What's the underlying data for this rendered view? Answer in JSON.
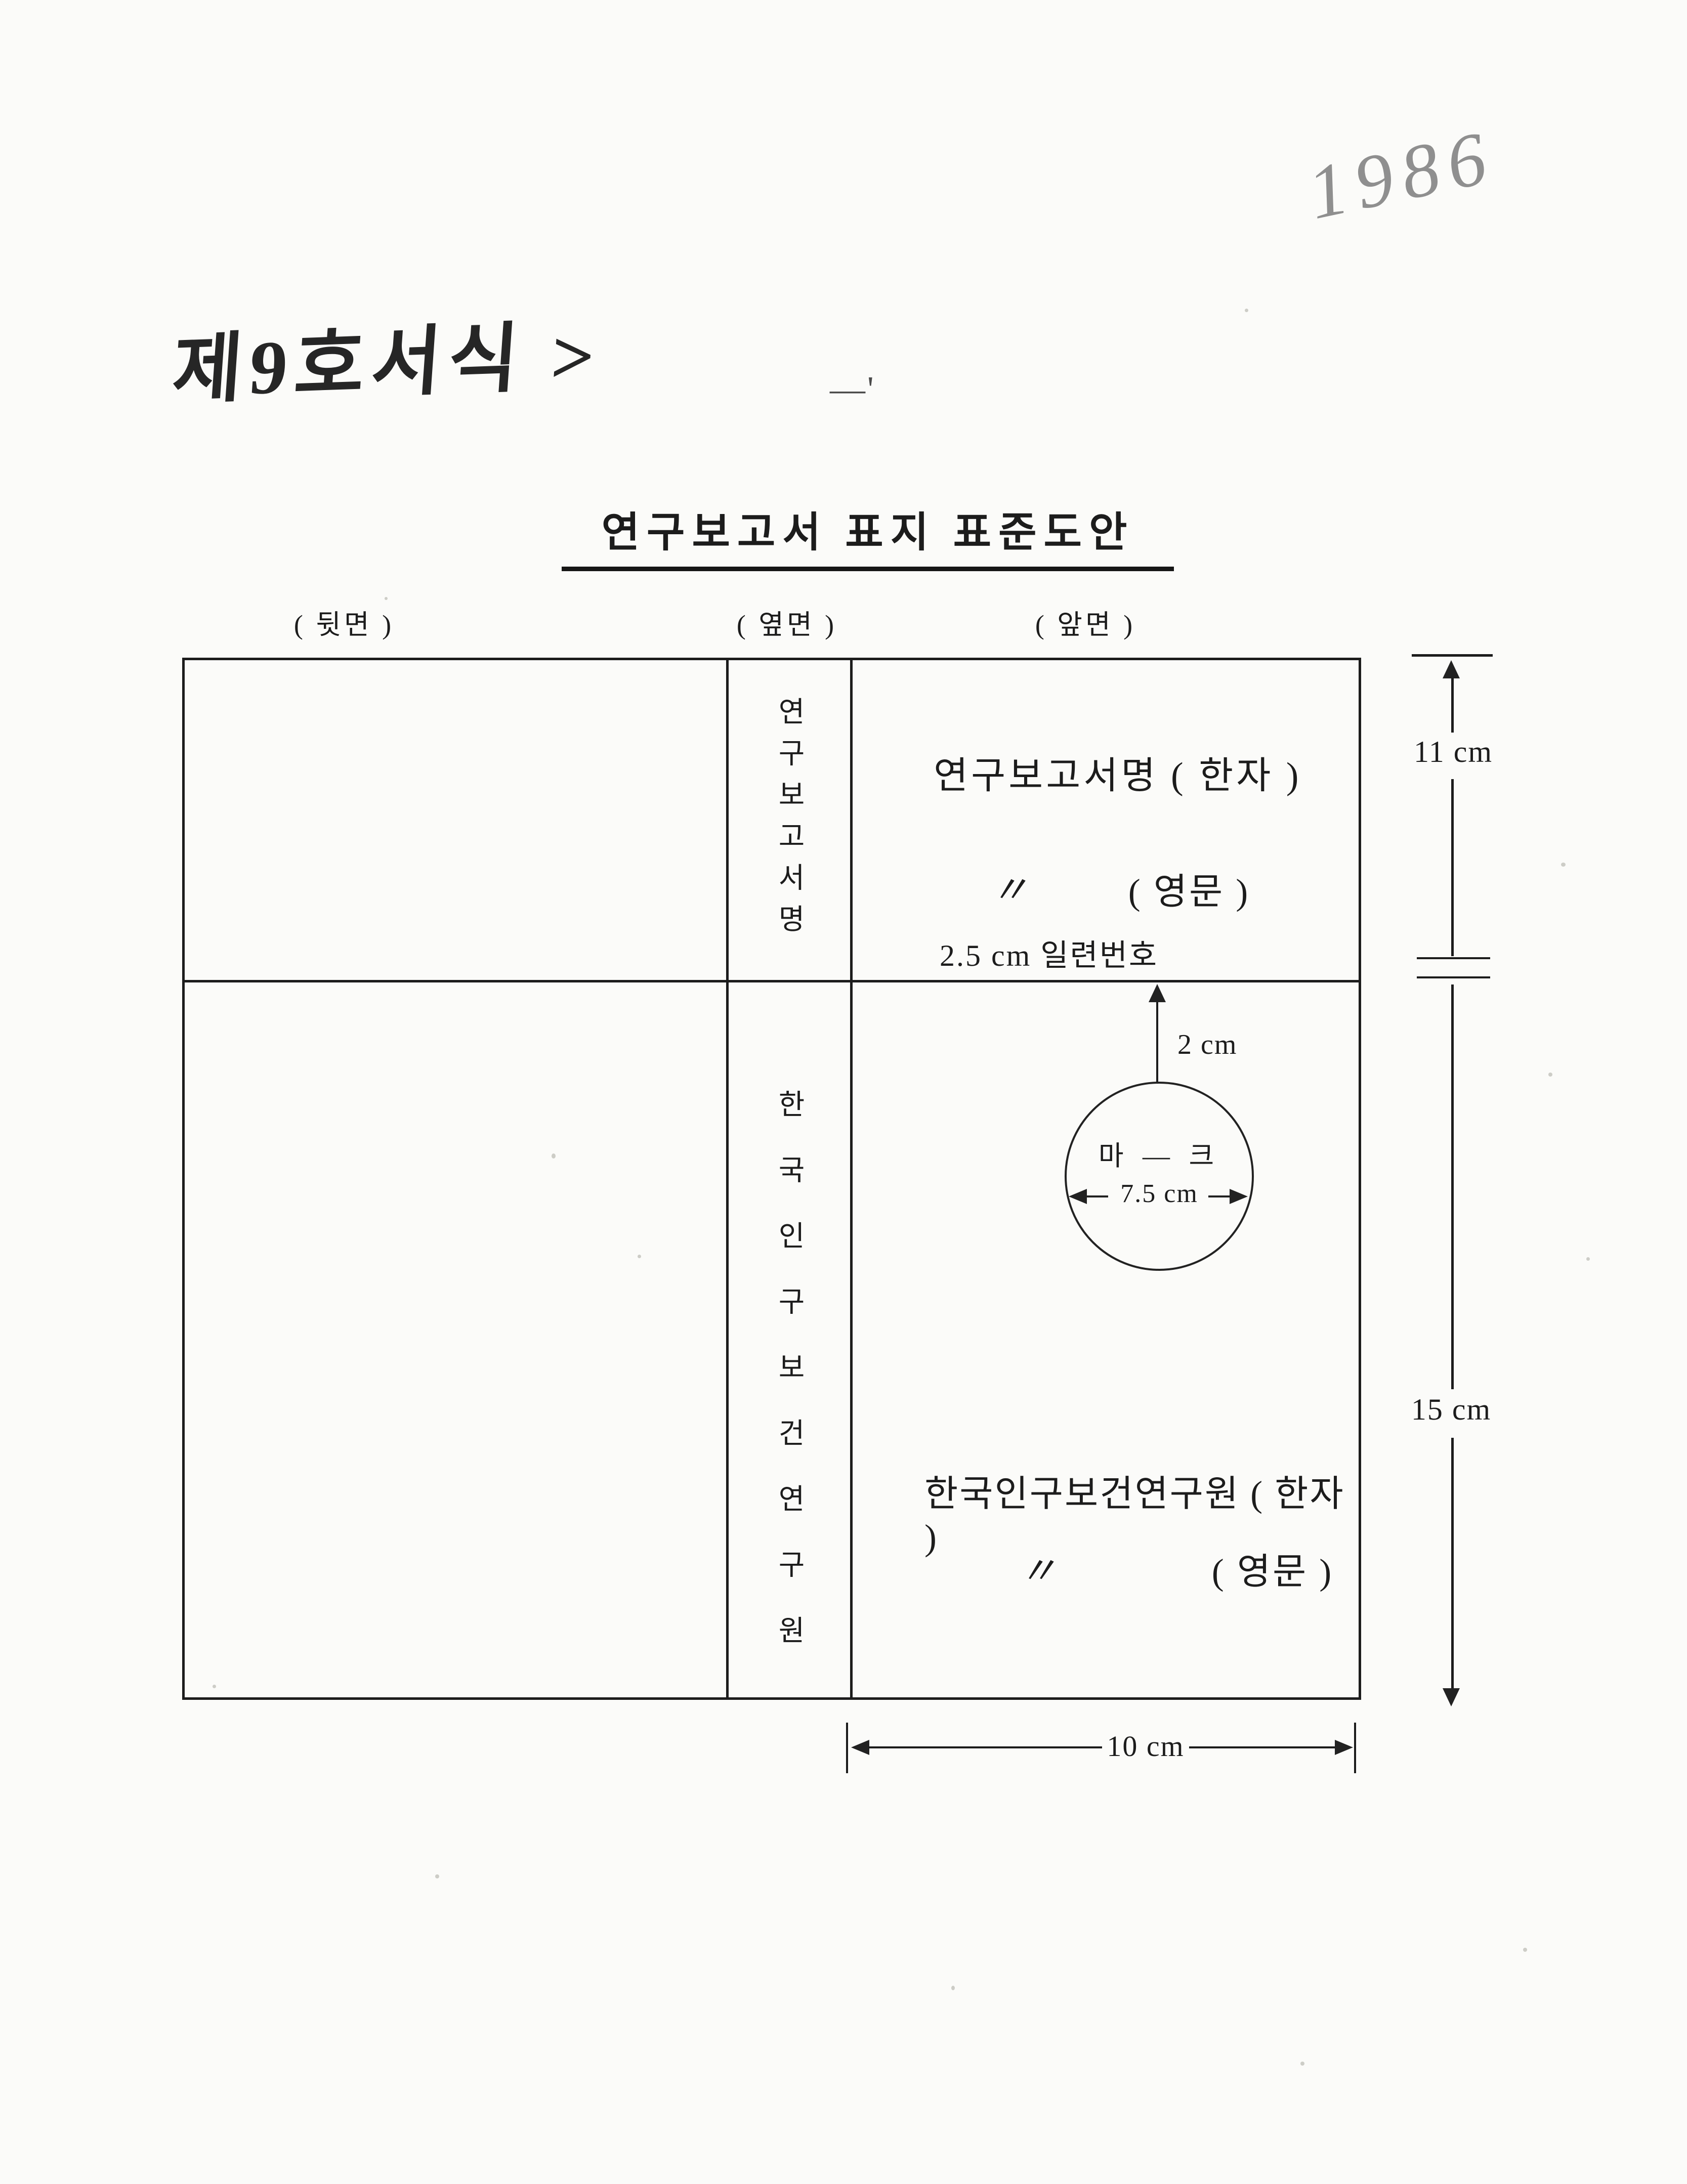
{
  "page": {
    "year_note": "1986",
    "form_note": "제9호서식 >",
    "stray_mark": "―'",
    "title": "연구보고서 표지 표준도안"
  },
  "panel_labels": {
    "back": "( 뒷면 )",
    "side": "( 옆면 )",
    "front": "( 앞면 )"
  },
  "spine": {
    "report_title_vertical": "연구보고서명",
    "org_name_vertical": "한국인구보건연구원"
  },
  "front": {
    "report_title_hanja": "연구보고서명 ( 한자 )",
    "ditto_mark": "〃",
    "report_title_english": "( 영문 )",
    "serial_note": "2.5 cm  일련번호",
    "mark_gap_label": "2 cm",
    "mark_text": "마 ― 크",
    "mark_diameter_label": "7.5 cm",
    "org_name_hanja": "한국인구보건연구원 ( 한자 )",
    "org_name_english": "( 영문 )"
  },
  "dimensions": {
    "upper_height": "11 cm",
    "lower_height": "15 cm",
    "front_width": "10 cm"
  },
  "colors": {
    "ink": "#1c1c1c",
    "pencil": "#8f8f8f",
    "paper": "#fbfbf9"
  }
}
